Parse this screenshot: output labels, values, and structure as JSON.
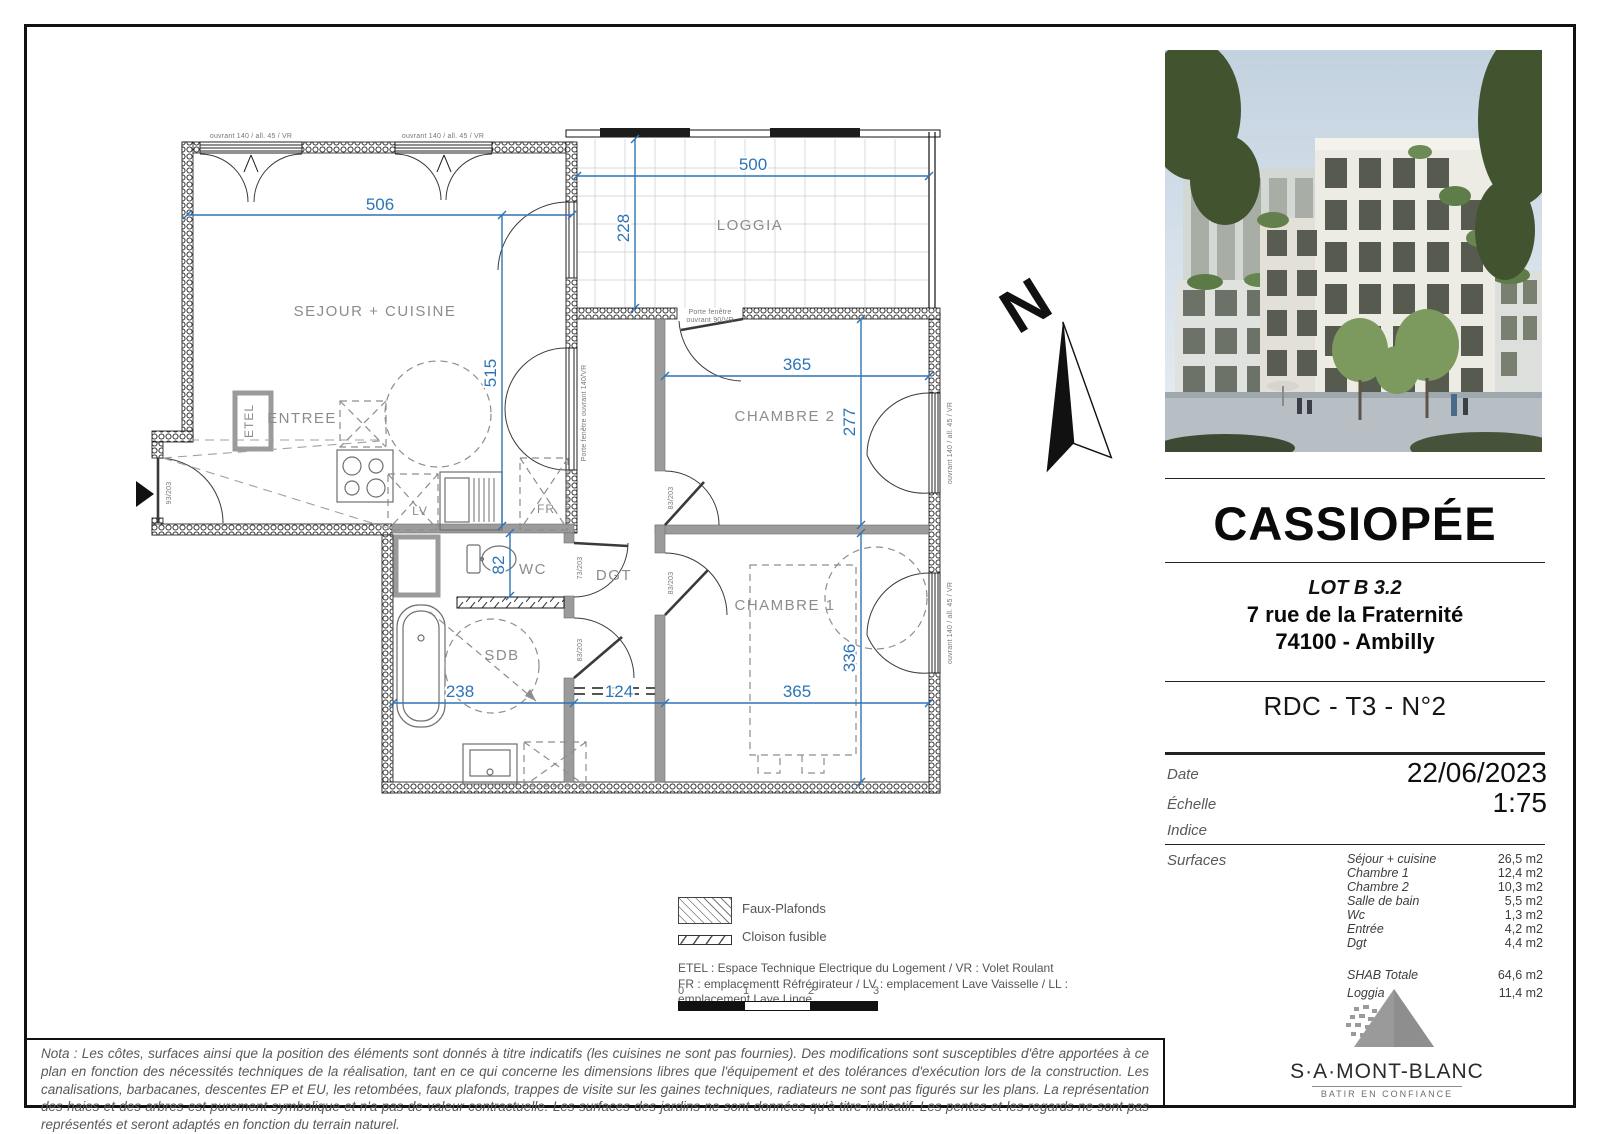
{
  "plan": {
    "rooms": {
      "sejour": "SEJOUR + CUISINE",
      "loggia": "LOGGIA",
      "entree": "ENTREE",
      "chambre2": "CHAMBRE 2",
      "chambre1": "CHAMBRE 1",
      "wc": "WC",
      "dgt": "DGT",
      "sdb": "SDB",
      "etel": "ETEL",
      "lv": "LV",
      "fr": "FR"
    },
    "dims": {
      "d506": "506",
      "d515": "515",
      "d500": "500",
      "d228": "228",
      "d365a": "365",
      "d277": "277",
      "d82": "82",
      "d238": "238",
      "d124": "124",
      "d365b": "365",
      "d336": "336"
    },
    "labels": {
      "win_top": "ouvrant 140 / all. 45 / VR",
      "win_right": "ouvrant 140 / all. 45 / VR",
      "pf140": "Porte fenêtre ouvrant 140/VR",
      "pf90_l1": "Porte fenêtre",
      "pf90_l2": "ouvrant 90/VR",
      "door_93": "93/203",
      "door_73": "73/203",
      "door_83": "83/203"
    },
    "north": "N"
  },
  "legend": {
    "faux_plafonds": "Faux-Plafonds",
    "cloison": "Cloison fusible",
    "etel_line1": "ETEL : Espace Technique Electrique du Logement /  VR : Volet Roulant",
    "etel_line2": "FR : emplacementt Réfrégirateur / LV : emplacement Lave Vaisselle / LL : emplacement Lave Linge",
    "scale_ticks": [
      "0",
      "1",
      "2",
      "3"
    ]
  },
  "title_block": {
    "project": "CASSIOPÉE",
    "lot": "LOT B 3.2",
    "address_line1": "7 rue de la Fraternité",
    "address_line2": "74100 - Ambilly",
    "unit": "RDC - T3 - N°2",
    "date_label": "Date",
    "date_value": "22/06/2023",
    "scale_label": "Échelle",
    "scale_value": "1:75",
    "index_label": "Indice",
    "surfaces_label": "Surfaces"
  },
  "surfaces": {
    "rows": [
      {
        "label": "Séjour + cuisine",
        "value": "26,5 m2"
      },
      {
        "label": "Chambre 1",
        "value": "12,4 m2"
      },
      {
        "label": "Chambre 2",
        "value": "10,3 m2"
      },
      {
        "label": "Salle de bain",
        "value": "5,5 m2"
      },
      {
        "label": "Wc",
        "value": "1,3 m2"
      },
      {
        "label": "Entrée",
        "value": "4,2 m2"
      },
      {
        "label": "Dgt",
        "value": "4,4 m2"
      }
    ],
    "totals": [
      {
        "label": "SHAB Totale",
        "value": "64,6 m2"
      },
      {
        "label": "Loggia",
        "value": "11,4 m2"
      }
    ]
  },
  "logo": {
    "name": "S·A·MONT-BLANC",
    "tagline": "BATIR EN CONFIANCE"
  },
  "nota": "Nota : Les côtes, surfaces ainsi que la position des éléments sont donnés à titre indicatifs (les cuisines ne sont pas fournies). Des modifications sont susceptibles d'être apportées à ce plan en fonction des nécessités techniques de la réalisation, tant en ce qui concerne les dimensions libres que l'équipement et des tolérances d'exécution lors de la construction. Les canalisations, barbacanes, descentes EP et EU, les retombées, faux plafonds, trappes de visite sur les gaines techniques, radiateurs ne sont pas figurés sur les plans. La représentation des haies et des arbres est purement symbolique et n'a pas de valeur contractuelle. Les surfaces des jardins ne sont données qu'à titre indicatif. Les pentes et les regards ne sont pas représentés et seront adaptés en fonction du terrain naturel."
}
